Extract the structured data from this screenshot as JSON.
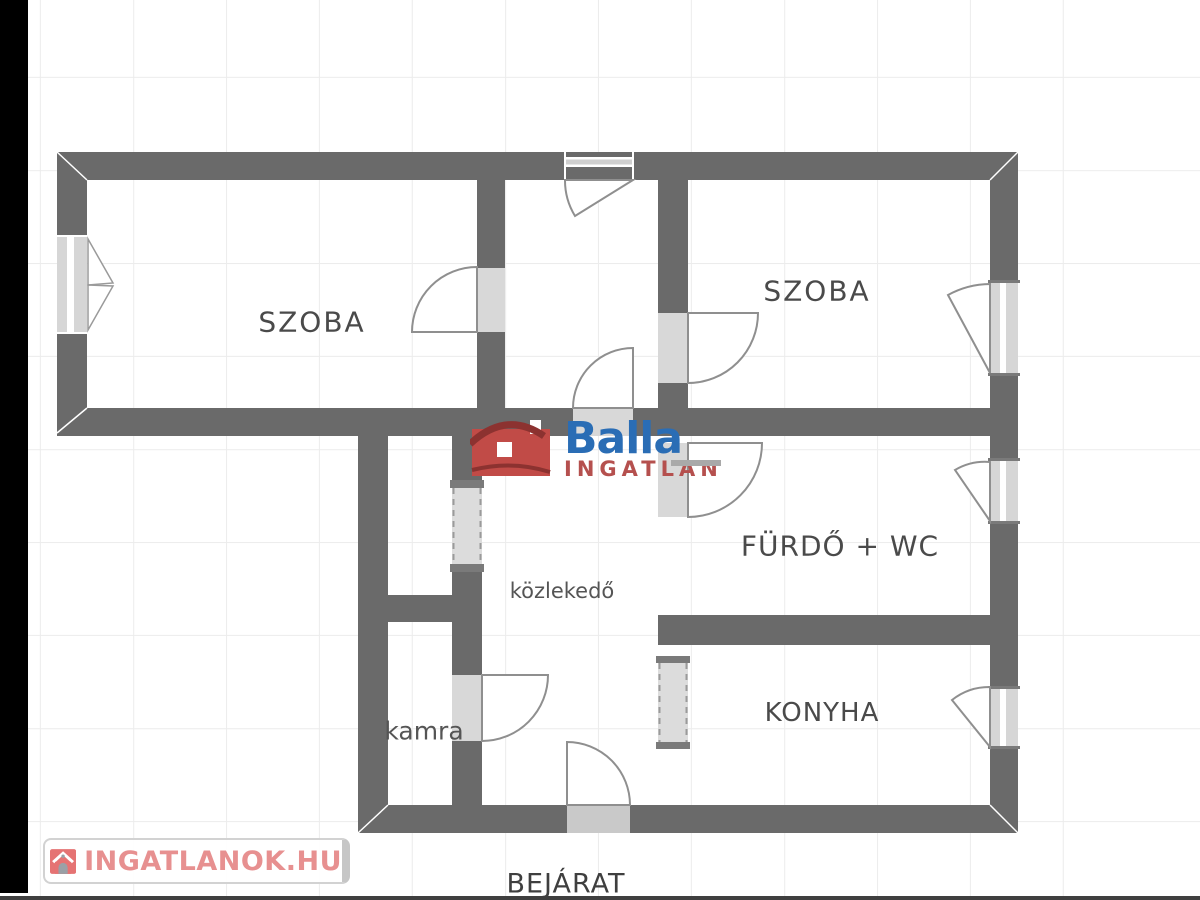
{
  "plan": {
    "rooms": [
      {
        "id": "szoba-left",
        "label": "SZOBA"
      },
      {
        "id": "szoba-right",
        "label": "SZOBA"
      },
      {
        "id": "bathroom",
        "label": "FÜRDŐ + WC"
      },
      {
        "id": "kitchen",
        "label": "KONYHA"
      },
      {
        "id": "hallway",
        "label": "közlekedő"
      },
      {
        "id": "pantry",
        "label": "kamra"
      }
    ],
    "entrance_label": "BEJÁRAT"
  },
  "branding": {
    "logo": {
      "name": "Balla",
      "subtitle": "INGATLAN",
      "name_color": "#2a6db5",
      "subtitle_color": "#b5504e",
      "house_color": "#c14b47"
    },
    "watermark": {
      "text": "INGATLANOK.HU",
      "text_color": "#e79090"
    }
  },
  "colors": {
    "wall": "#6a6a6a",
    "door_opening": "#d8d8d8",
    "window_fill": "#d6d6d6",
    "entrance_opening": "#c9c9c9",
    "grid_line": "#ececec",
    "letterbox": "#000000"
  }
}
